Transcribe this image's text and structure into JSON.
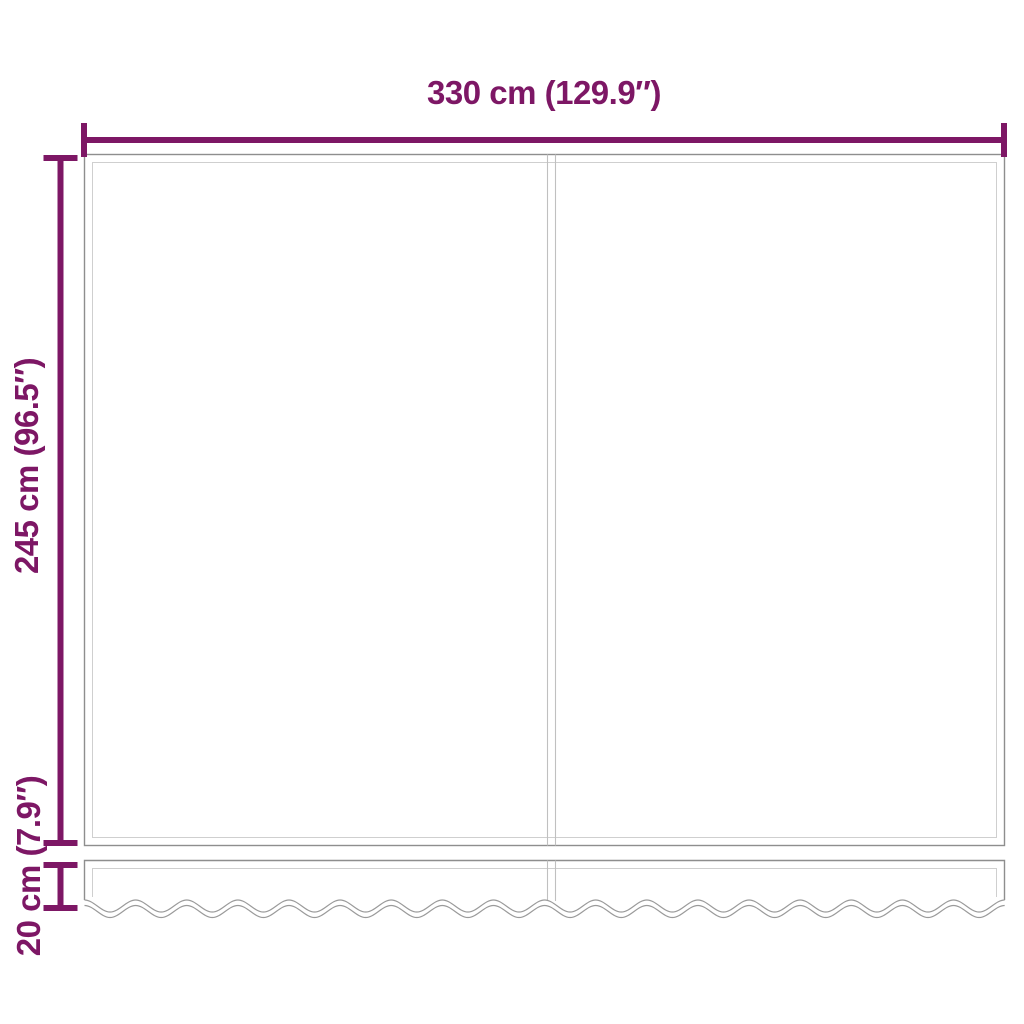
{
  "product_diagram": {
    "description": "awning-replacement-fabric-dimension-diagram",
    "labels": {
      "width": "330 cm (129.9″)",
      "height": "245 cm (96.5″)",
      "valance_height": "20 cm (7.9″)"
    },
    "colors": {
      "dimension_accent": "#7D1765",
      "fabric_outline": "#8e8e8e",
      "fabric_inner_line": "#cfcfcf",
      "background": "#ffffff"
    }
  }
}
